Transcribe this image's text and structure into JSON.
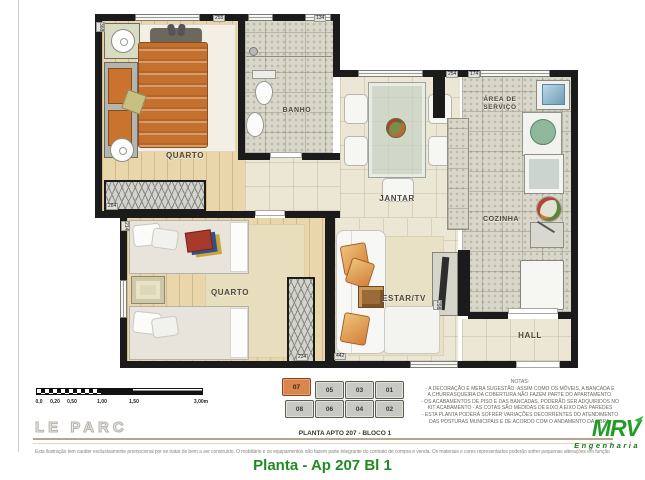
{
  "page": {
    "watermark": "LE PARC",
    "plan_caption": "PLANTA APTO 207 - BLOCO 1",
    "disclaimer": "Esta ilustração tem caráter exclusivamente promocional por se tratar de bem a ser construído. O mobiliário e os equipamentos não fazem parte integrante do contrato de compra e venda. Os materiais e cores representados poderão sofrer pequenas alterações em função da disponibilidade dos mesmos no mercado.",
    "title": "Planta - Ap 207 Bl 1"
  },
  "brand": {
    "name": "MRV",
    "sub": "Engenharia"
  },
  "plan": {
    "rooms": {
      "quarto1": "QUARTO",
      "banho": "BANHO",
      "jantar": "JANTAR",
      "area_servico_line1": "ÁREA DE",
      "area_servico_line2": "SERVIÇO",
      "cozinha": "COZINHA",
      "estar": "ESTAR/TV",
      "quarto2": "QUARTO",
      "hall": "HALL"
    },
    "dimensions": {
      "quarto1_top": "255",
      "banho_top": "134",
      "quarto1_left": "368",
      "quarto1_wardrobe": "284",
      "jantar_top": "254",
      "servico_top": "174",
      "quarto2_left": "214",
      "quarto2_wardrobe": "234",
      "estar_bottom": "442",
      "tv_panel": "298"
    }
  },
  "scale_bar": {
    "labels": [
      "0,0",
      "0,20",
      "0,50",
      "1,00",
      "1,50",
      "3,00m"
    ]
  },
  "block_diagram": {
    "units": [
      "07",
      "05",
      "03",
      "01",
      "08",
      "06",
      "04",
      "02"
    ],
    "highlighted_unit": "07"
  },
  "notes": {
    "title": "NOTAS:",
    "lines": [
      "- A DECORAÇÃO É MERA SUGESTÃO. ASSIM COMO OS MÓVEIS, A BANCADA E",
      "A CHURRASQUEIRA DA COBERTURA NÃO FAZEM PARTE DO APARTAMENTO.",
      "- OS ACABAMENTOS DE  PISO E DAS BANCADAS, PODERÃO SER ADQUIRIDOS NO",
      "KIT ACABAMENTO - AS COTAS SÃO MEDIDAS DE EIXO A EIXO DAS PAREDES",
      "- ESTA PLANTA PODERÁ SOFRER VARIAÇÕES DECORRENTES DO ATENDIMENTO",
      "DAS POSTURAS  MUNICIPAIS E DE ACORDO COM O ANDAMENTO DA OBRA."
    ]
  },
  "colors": {
    "accent_green": "#1e8c22",
    "brand_green": "#219d26",
    "highlight_orange": "#d8854e",
    "bed_orange": "#c4712f",
    "wall_black": "#1b1b1b"
  }
}
